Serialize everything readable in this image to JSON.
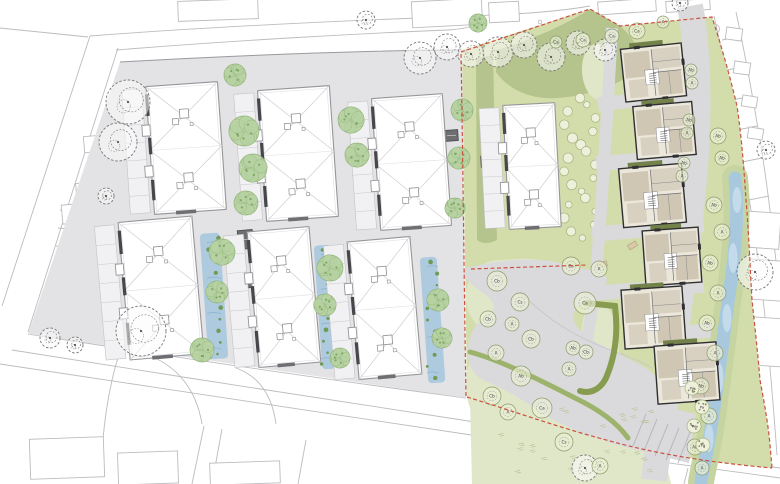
{
  "meta": {
    "type": "architectural-site-plan",
    "canvas_width": 780,
    "canvas_height": 484
  },
  "palette": {
    "background": "#ffffff",
    "context_stroke": "#bcbcbf",
    "curb_stroke": "#a9a9ad",
    "site_paving": "#e3e3e5",
    "hardscape": "#dadadc",
    "green_zone": "#d3dcab",
    "lawn_patch": "#e0e6c8",
    "olive_band": "#b5c38c",
    "hedge": "#879c4f",
    "hedge_light": "#9db36b",
    "shrub_fill": "#eef0dc",
    "shrub_stroke": "#a3b47e",
    "soft_tree_fill": "#b7d1a1",
    "soft_tree_stroke": "#8fb377",
    "soft_tree_dot": "#7fa765",
    "sketch_tree_stroke": "#767679",
    "stream_bank": "#c6d4a2",
    "stream_water": "#a8c8de",
    "water_patch": "#c3dbea",
    "rain_garden": "#a3c6de",
    "rain_plant": "#6f9b53",
    "building_fill": "#ffffff",
    "building_stroke": "#96969a",
    "roof_line": "#cfcfd3",
    "dark_bar": "#47474b",
    "gallery_fill": "#f1f1f3",
    "detail_wall": "#2f2f31",
    "detail_base": "#ece7db",
    "detail_tan": "#cfc7b4",
    "detail_tan_light": "#d8d1c1",
    "detail_roofband": "#73814b",
    "utility_fill": "#6e6e71",
    "boundary_red": "#cc5240",
    "bench_fill": "#d9c9a8",
    "grass_stroke": "#b8c394",
    "label_ink": "#3a3a3a"
  },
  "context": {
    "paths": [
      "M90,36 L2,306",
      "M118,48 L28,332",
      "M0,28 L88,37",
      "M90,36 C220,26 360,20 470,16 C520,14 556,12 590,6",
      "M116,50 C240,40 370,33 448,30 C462,29 473,27 483,23",
      "M28,334 C180,358 330,380 466,398",
      "M12,350 C160,374 320,398 462,420 C560,436 670,452 780,468",
      "M0,364 C160,388 330,414 478,436 C580,452 680,464 780,478",
      "M204,426 L192,484",
      "M222,429 L212,484",
      "M306,440 L298,484",
      "M482,452 L476,484",
      "M688,468 L684,484",
      "M150,356 C176,366 196,388 202,424",
      "M236,368 C258,376 272,394 276,424",
      "M120,352 C110,380 104,420 102,452",
      "M714,16 C724,60 733,105 741,150 C748,190 756,240 762,290 C768,340 773,400 777,455",
      "M736,12 C746,58 754,104 762,152 C768,192 774,240 779,290",
      "M722,40 L742,36",
      "M727,70 L747,66",
      "M732,100 L752,96",
      "M737,130 L757,126",
      "M742,162 L762,158",
      "M749,200 L769,196",
      "M754,240 L774,236",
      "M760,285 L779,281",
      "M60,210 L84,212",
      "M58,228 L82,230",
      "M56,246 L80,248",
      "M54,264 L78,266",
      "M52,282 L76,284",
      "M50,300 L74,302"
    ],
    "rects": [
      [
        178,
        0,
        80,
        20,
        -2
      ],
      [
        412,
        0,
        70,
        26,
        -3
      ],
      [
        489,
        2,
        30,
        20,
        -3
      ],
      [
        598,
        0,
        58,
        13,
        -4
      ],
      [
        666,
        0,
        44,
        11,
        -4
      ],
      [
        84,
        136,
        17,
        16,
        -5
      ],
      [
        62,
        204,
        26,
        19,
        -5
      ],
      [
        76,
        183,
        12,
        10,
        -5
      ],
      [
        30,
        438,
        74,
        40,
        -2
      ],
      [
        118,
        452,
        60,
        32,
        -2
      ],
      [
        210,
        462,
        70,
        22,
        -2
      ],
      [
        740,
        212,
        40,
        36,
        4
      ],
      [
        746,
        260,
        38,
        40,
        4
      ],
      [
        752,
        318,
        34,
        48,
        4
      ],
      [
        726,
        28,
        16,
        12,
        8
      ],
      [
        734,
        62,
        16,
        12,
        8
      ],
      [
        742,
        96,
        15,
        11,
        9
      ],
      [
        748,
        128,
        15,
        11,
        9
      ]
    ],
    "circles": [
      [
        715,
        29,
        4.5
      ],
      [
        715,
        29,
        1.3
      ],
      [
        374,
        336,
        2.2
      ],
      [
        540,
        22,
        1.8
      ]
    ]
  },
  "site": {
    "paving": "M120,62 C260,54 390,50 462,50 L466,398 L28,334 Z",
    "top_edge": "M120,62 C260,54 390,50 462,50"
  },
  "green_zone": {
    "outline": "M462,50 L590,9 L620,26 L712,17 C721,45 730,76 737,106 C742,140 744,170 746,200 C749,235 750,268 752,300 C755,328 758,355 760,380 C764,402 768,422 770,445 L772,468 C716,463 660,455 610,441 C560,428 510,410 467,397 Z",
    "olive_band": "M497,50 C530,40 562,27 590,9 L620,26 C636,40 643,55 638,70 C614,88 584,96 557,98 C529,100 507,88 496,72 Z",
    "left_strip": "M476,58 L493,55 L497,240 C489,244 482,244 477,240 Z",
    "lawn_patches": [
      [
        515,
        272,
        46,
        13,
        -3
      ],
      [
        500,
        298,
        34,
        38,
        -10
      ],
      [
        506,
        388,
        40,
        52,
        -8
      ],
      [
        600,
        345,
        19,
        44,
        -4
      ],
      [
        598,
        72,
        16,
        28,
        -5
      ]
    ],
    "bottom_lawn": "M470,398 C510,394 556,402 598,418 C630,430 652,444 662,458 C668,470 670,478 671,484 L472,484 Z",
    "shrub_patch": {
      "cx": 580,
      "cy": 168,
      "rx": 20,
      "ry": 70,
      "count": 22
    },
    "hedges": [
      {
        "d": "M586,303 L615,306 C618,330 616,355 606,378 C600,390 590,394 580,391",
        "width": 6,
        "tone": "dark"
      },
      {
        "d": "M470,352 C500,360 540,380 575,398 C600,410 618,424 628,438",
        "width": 5,
        "tone": "light"
      }
    ]
  },
  "hardscape": {
    "plaza": "M466,268 C505,258 545,257 566,265 C585,272 600,267 606,277 C611,287 592,296 580,305 C569,313 572,326 588,337 C610,352 641,362 655,375 C668,388 669,412 661,431 C652,449 625,446 600,439 C574,431 551,420 534,408 C519,397 505,390 492,384 C477,378 468,372 468,350 C469,330 479,320 491,312 C499,306 489,296 479,290 C470,284 459,273 466,268 Z",
    "road": {
      "d": "M690,6 C700,60 699,130 693,190 C687,252 678,318 668,385 C662,425 657,455 654,480",
      "width": 26
    },
    "walk": {
      "d": "M612,28 C608,100 604,170 598,250 C595,295 590,325 585,348",
      "width": 12
    },
    "aprons": [
      [
        598,
        92,
        100,
        14,
        -6
      ],
      [
        596,
        152,
        104,
        15,
        -5
      ],
      [
        592,
        222,
        112,
        15,
        -5
      ],
      [
        588,
        282,
        116,
        15,
        -4
      ],
      [
        640,
        326,
        72,
        14,
        -4
      ]
    ],
    "parking_poly": "M610,390 C640,398 668,408 696,414 L689,463 C660,456 632,449 607,442 Z",
    "parking_lines": [
      [
        646,
        414,
        633,
        446
      ],
      [
        657,
        419,
        644,
        451
      ],
      [
        668,
        424,
        655,
        456
      ],
      [
        679,
        428,
        666,
        460
      ],
      [
        690,
        432,
        678,
        463
      ]
    ],
    "benches": [
      [
        628,
        243,
        9,
        5,
        -30
      ],
      [
        597,
        262,
        10,
        5,
        -15
      ]
    ],
    "plaza_line": "M520,292 C540,312 562,330 600,346 C620,354 640,360 652,368"
  },
  "water": {
    "stream": {
      "d": "M735,178 C739,215 735,255 729,295 C723,340 717,390 710,435 C706,458 703,470 701,482",
      "bank_width": 26,
      "water_width": 13
    },
    "patches": [
      [
        737,
        200,
        4.5,
        13
      ],
      [
        733,
        258,
        4.5,
        15
      ],
      [
        727,
        318,
        4.5,
        14
      ],
      [
        719,
        378,
        4.5,
        15
      ],
      [
        709,
        438,
        4.5,
        14
      ]
    ],
    "rain_gardens": [
      [
        204,
        233,
        20,
        126,
        -4
      ],
      [
        318,
        245,
        17,
        124,
        -4
      ],
      [
        424,
        257,
        17,
        126,
        -4
      ]
    ]
  },
  "buildings_large": [
    {
      "x": 150,
      "y": 84,
      "w": 72,
      "h": 128,
      "rot": -4,
      "seg": 2
    },
    {
      "x": 262,
      "y": 88,
      "w": 72,
      "h": 131,
      "rot": -4,
      "seg": 2
    },
    {
      "x": 376,
      "y": 96,
      "w": 71,
      "h": 132,
      "rot": -4,
      "seg": 2
    },
    {
      "x": 506,
      "y": 104,
      "w": 52,
      "h": 124,
      "rot": -3,
      "seg": 2
    },
    {
      "x": 124,
      "y": 219,
      "w": 74,
      "h": 138,
      "rot": -5,
      "seg": 2
    },
    {
      "x": 253,
      "y": 229,
      "w": 62,
      "h": 136,
      "rot": -5,
      "seg": 2
    },
    {
      "x": 353,
      "y": 239,
      "w": 63,
      "h": 138,
      "rot": -5,
      "seg": 2
    }
  ],
  "buildings_detail": [
    [
      623,
      46,
      61,
      53,
      -6
    ],
    [
      635,
      104,
      59,
      53,
      -5
    ],
    [
      621,
      166,
      63,
      59,
      -5
    ],
    [
      644,
      229,
      56,
      55,
      -4
    ],
    [
      623,
      288,
      61,
      59,
      -4
    ],
    [
      656,
      344,
      62,
      58,
      -4
    ]
  ],
  "utility_blocks": [
    [
      445,
      130,
      13,
      11,
      -4
    ],
    [
      238,
      230,
      15,
      19,
      -5
    ],
    [
      240,
      277,
      12,
      11,
      -5
    ],
    [
      481,
      156,
      11,
      11,
      -3
    ]
  ],
  "trees": {
    "soft": [
      [
        244,
        131,
        15
      ],
      [
        253,
        168,
        14
      ],
      [
        246,
        203,
        12
      ],
      [
        235,
        75,
        11
      ],
      [
        351,
        120,
        13
      ],
      [
        357,
        155,
        12
      ],
      [
        462,
        110,
        11
      ],
      [
        459,
        158,
        11
      ],
      [
        455,
        208,
        10
      ],
      [
        222,
        252,
        13
      ],
      [
        217,
        292,
        11
      ],
      [
        202,
        350,
        12
      ],
      [
        330,
        268,
        13
      ],
      [
        325,
        305,
        11
      ],
      [
        340,
        358,
        10
      ],
      [
        438,
        300,
        11
      ],
      [
        442,
        338,
        10
      ],
      [
        478,
        23,
        9
      ]
    ],
    "sketch": [
      [
        128,
        102,
        22
      ],
      [
        118,
        142,
        19
      ],
      [
        106,
        196,
        8
      ],
      [
        141,
        331,
        25
      ],
      [
        420,
        58,
        16
      ],
      [
        447,
        47,
        13
      ],
      [
        471,
        54,
        13
      ],
      [
        498,
        52,
        15
      ],
      [
        524,
        45,
        13
      ],
      [
        551,
        57,
        14
      ],
      [
        578,
        43,
        12
      ],
      [
        605,
        50,
        11
      ],
      [
        366,
        20,
        9
      ],
      [
        755,
        272,
        18
      ],
      [
        766,
        150,
        9
      ],
      [
        50,
        338,
        10
      ],
      [
        75,
        345,
        8
      ],
      [
        585,
        468,
        13
      ],
      [
        680,
        3,
        8
      ]
    ],
    "labeled": [
      [
        637,
        31,
        8,
        "Ca"
      ],
      [
        612,
        36,
        7,
        "Ca"
      ],
      [
        583,
        40,
        7,
        "Ca"
      ],
      [
        556,
        42,
        6,
        "Ca"
      ],
      [
        663,
        22,
        6,
        "A"
      ],
      [
        691,
        70,
        6,
        "Ab"
      ],
      [
        692,
        83,
        6,
        "A"
      ],
      [
        689,
        120,
        6,
        "Ab"
      ],
      [
        687,
        133,
        6,
        "A"
      ],
      [
        684,
        163,
        6,
        "Ab"
      ],
      [
        682,
        176,
        6,
        "A"
      ],
      [
        718,
        136,
        8,
        "Ab"
      ],
      [
        722,
        158,
        7,
        "Ab"
      ],
      [
        714,
        205,
        8,
        "Ab"
      ],
      [
        722,
        232,
        8,
        "A"
      ],
      [
        710,
        263,
        8,
        "Ab"
      ],
      [
        718,
        293,
        8,
        "A"
      ],
      [
        707,
        323,
        8,
        "Ab"
      ],
      [
        715,
        353,
        8,
        "A"
      ],
      [
        701,
        386,
        8,
        "Ab"
      ],
      [
        709,
        416,
        8,
        "A"
      ],
      [
        695,
        447,
        8,
        "Ab"
      ],
      [
        702,
        468,
        7,
        "A"
      ],
      [
        497,
        281,
        10,
        "Cb"
      ],
      [
        520,
        302,
        9,
        "Cs"
      ],
      [
        488,
        319,
        8,
        "Cb"
      ],
      [
        512,
        324,
        7,
        "A"
      ],
      [
        531,
        339,
        9,
        "Cb"
      ],
      [
        496,
        353,
        8,
        "A"
      ],
      [
        521,
        376,
        10,
        "Ab"
      ],
      [
        492,
        396,
        9,
        "Cb"
      ],
      [
        508,
        412,
        8,
        "A"
      ],
      [
        571,
        266,
        9,
        "Ca"
      ],
      [
        599,
        269,
        8,
        "A"
      ],
      [
        585,
        303,
        11,
        "Ca"
      ],
      [
        573,
        348,
        7,
        "Ab"
      ],
      [
        586,
        352,
        7,
        "Cb"
      ],
      [
        569,
        369,
        7,
        "A"
      ],
      [
        542,
        408,
        10,
        "Ca"
      ],
      [
        564,
        442,
        9,
        "Cs"
      ],
      [
        600,
        466,
        8,
        "A"
      ]
    ],
    "stipple": [
      [
        692,
        388,
        7,
        "Pa"
      ],
      [
        702,
        407,
        7,
        "Pa"
      ],
      [
        694,
        426,
        7,
        "Pa"
      ],
      [
        703,
        445,
        7,
        "Pa"
      ]
    ]
  },
  "boundary": {
    "dash": "4,2.5",
    "paths": [
      "M461,52 L590,9 L620,26 L712,17 C721,45 730,76 737,106 C742,140 744,170 746,200 C749,235 750,268 752,300 C755,328 758,355 760,380 C764,402 768,422 770,445 L772,468",
      "M467,397 C510,410 560,428 610,441 C660,455 716,463 772,468",
      "M461,54 C463,160 464,280 466,396",
      "M471,269 L587,265"
    ]
  },
  "grass": {
    "x0": 480,
    "x1": 650,
    "y0": 408,
    "y1": 476,
    "count": 26
  }
}
